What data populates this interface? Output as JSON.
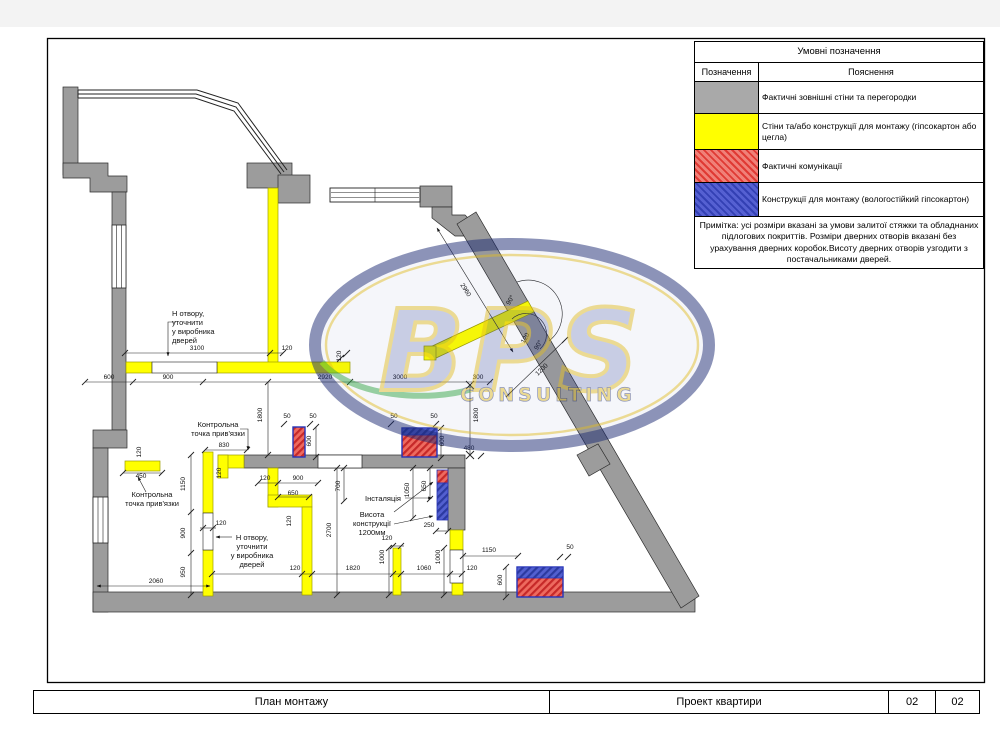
{
  "legend": {
    "title": "Умовні позначення",
    "columns": [
      "Позначення",
      "Пояснення"
    ],
    "rows": [
      {
        "swatch": "gray-solid",
        "label": "Фактичні зовнішні стіни та перегородки"
      },
      {
        "swatch": "yellow-solid",
        "label": "Стіни та/або конструкції для монтажу (гіпсокартон або цегла)"
      },
      {
        "swatch": "red-hatch",
        "label": "Фактичні комунікації"
      },
      {
        "swatch": "blue-hatch",
        "label": "Конструкції для монтажу (вологостійкий гіпсокартон)"
      }
    ],
    "note": "Примітка: усі розміри вказані за умови залитої стяжки та обладнаних підлогових покриттів. Розміри дверних отворів вказані без урахування дверних коробок.Висоту дверних отворів узгодити з постачальниками дверей."
  },
  "titleblock": {
    "drawing_title": "План монтажу",
    "project_title": "Проект квартири",
    "sheet_number": "02",
    "page_number": "02"
  },
  "watermark": {
    "name": "BPS",
    "subtitle": "CONSULTING"
  },
  "colors": {
    "wall_gray": "#9c9c9c",
    "construction_yellow": "#ffff00",
    "comm_red": "#e03a34",
    "mount_blue": "#3340b4",
    "watermark_navy": "#1b2a74",
    "watermark_gold": "#d9b62a"
  },
  "plan": {
    "dim_labels": [
      {
        "t": "3100",
        "x": 197,
        "y": 350
      },
      {
        "t": "120",
        "x": 287,
        "y": 350
      },
      {
        "t": "120",
        "x": 341,
        "y": 356,
        "r": -90
      },
      {
        "t": "600",
        "x": 109,
        "y": 379
      },
      {
        "t": "900",
        "x": 168,
        "y": 379
      },
      {
        "t": "2920",
        "x": 325,
        "y": 379
      },
      {
        "t": "3000",
        "x": 400,
        "y": 379
      },
      {
        "t": "300",
        "x": 478,
        "y": 379
      },
      {
        "t": "1800",
        "x": 262,
        "y": 415,
        "r": -90
      },
      {
        "t": "1800",
        "x": 478,
        "y": 415,
        "r": -90
      },
      {
        "t": "480",
        "x": 469,
        "y": 450
      },
      {
        "t": "2960",
        "x": 464,
        "y": 291,
        "r": 58
      },
      {
        "t": "1200",
        "x": 543,
        "y": 371,
        "r": -44
      },
      {
        "t": "120",
        "x": 527,
        "y": 339,
        "r": -60
      },
      {
        "t": "90°",
        "x": 512,
        "y": 301,
        "r": -60
      },
      {
        "t": "90°",
        "x": 540,
        "y": 346,
        "r": -60
      },
      {
        "t": "120",
        "x": 141,
        "y": 452,
        "r": -90
      },
      {
        "t": "450",
        "x": 141,
        "y": 478
      },
      {
        "t": "2060",
        "x": 156,
        "y": 583
      },
      {
        "t": "1150",
        "x": 185,
        "y": 484,
        "r": -90
      },
      {
        "t": "900",
        "x": 185,
        "y": 533,
        "r": -90
      },
      {
        "t": "950",
        "x": 185,
        "y": 572,
        "r": -90
      },
      {
        "t": "830",
        "x": 224,
        "y": 447
      },
      {
        "t": "120",
        "x": 221,
        "y": 473,
        "r": -90
      },
      {
        "t": "120",
        "x": 221,
        "y": 525
      },
      {
        "t": "120",
        "x": 265,
        "y": 480
      },
      {
        "t": "900",
        "x": 298,
        "y": 480
      },
      {
        "t": "650",
        "x": 293,
        "y": 495
      },
      {
        "t": "120",
        "x": 291,
        "y": 521,
        "r": -90
      },
      {
        "t": "700",
        "x": 340,
        "y": 486,
        "r": -90
      },
      {
        "t": "2700",
        "x": 331,
        "y": 530,
        "r": -90
      },
      {
        "t": "1050",
        "x": 409,
        "y": 490,
        "r": -90
      },
      {
        "t": "650",
        "x": 426,
        "y": 486,
        "r": -90
      },
      {
        "t": "250",
        "x": 429,
        "y": 527
      },
      {
        "t": "120",
        "x": 387,
        "y": 540
      },
      {
        "t": "1000",
        "x": 384,
        "y": 557,
        "r": -90
      },
      {
        "t": "1000",
        "x": 440,
        "y": 557,
        "r": -90
      },
      {
        "t": "120",
        "x": 295,
        "y": 570
      },
      {
        "t": "1820",
        "x": 353,
        "y": 570
      },
      {
        "t": "1060",
        "x": 424,
        "y": 570
      },
      {
        "t": "120",
        "x": 472,
        "y": 570
      },
      {
        "t": "1150",
        "x": 489,
        "y": 552
      },
      {
        "t": "50",
        "x": 570,
        "y": 549
      },
      {
        "t": "600",
        "x": 502,
        "y": 580,
        "r": -90
      },
      {
        "t": "50",
        "x": 287,
        "y": 418
      },
      {
        "t": "50",
        "x": 313,
        "y": 418
      },
      {
        "t": "600",
        "x": 311,
        "y": 441,
        "r": -90
      },
      {
        "t": "50",
        "x": 394,
        "y": 418
      },
      {
        "t": "50",
        "x": 434,
        "y": 418
      },
      {
        "t": "600",
        "x": 444,
        "y": 441,
        "r": -90
      }
    ],
    "note_labels": [
      {
        "lines": [
          "Н отвору,",
          "уточнити",
          "у виробника",
          "дверей"
        ],
        "x": 172,
        "y": 316,
        "anchor": "start"
      },
      {
        "lines": [
          "Контрольна",
          "точка прив'язки"
        ],
        "x": 218,
        "y": 427,
        "anchor": "middle"
      },
      {
        "lines": [
          "Контрольна",
          "точка прив'язки"
        ],
        "x": 152,
        "y": 497,
        "anchor": "middle"
      },
      {
        "lines": [
          "Н отвору,",
          "уточнити",
          "у виробника",
          "дверей"
        ],
        "x": 252,
        "y": 540,
        "anchor": "middle"
      },
      {
        "lines": [
          "Інсталяція"
        ],
        "x": 383,
        "y": 501,
        "anchor": "middle"
      },
      {
        "lines": [
          "Висота",
          "конструкції",
          "1200мм"
        ],
        "x": 372,
        "y": 517,
        "anchor": "middle"
      }
    ]
  }
}
